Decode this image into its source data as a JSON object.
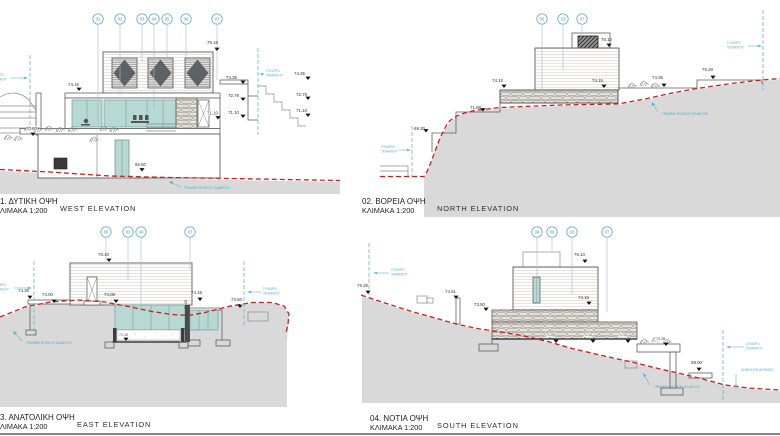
{
  "sheet": {
    "background": "#ffffff",
    "border_color": "#3a3a3a"
  },
  "colors": {
    "glass": "#b7d8d3",
    "terrain": "#d9d9d9",
    "ground_line_red": "#cc1f1f",
    "annotation_teal": "#57a8c7",
    "marker_blue": "#4a92b4"
  },
  "annotations": {
    "boundary_l1": "ΣΥΝΟΡΟ",
    "boundary_l2": "ΤΕΜΑΧΙΟΥ",
    "ground_line": "ΓΡΑΜΜΗ ΦΥΣΙΚΟΥ ΕΔΑΦΟΥΣ",
    "public_road": "ΔΗΜΟΣΙΟΣ ΔΡΟΜΟΣ"
  },
  "views": {
    "west": {
      "title": "1. ΔΥΤΙΚΗ ΟΨΗ",
      "scale_label": "ΛΙΜΑΚΑ 1:200",
      "title_en": "WEST ELEVATION",
      "markers": [
        "01",
        "02",
        "03",
        "04",
        "05",
        "06",
        "07"
      ],
      "levels": [
        "78.19",
        "74.15",
        "74.35",
        "72.79",
        "71.10",
        "74.35",
        "72.79",
        "71.10",
        "71.10",
        "70.80",
        "66.50"
      ]
    },
    "north": {
      "title": "02. ΒΟΡΕΙΑ ΟΨΗ",
      "scale_label": "ΚΛΙΜΑΚΑ 1:200",
      "title_en": "NORTH ELEVATION",
      "markers": [
        "06",
        "03",
        "07"
      ],
      "levels": [
        "76.10",
        "74.15",
        "74.15",
        "74.35",
        "75.28",
        "71.68",
        "69.30"
      ]
    },
    "east": {
      "title": "3. ΑΝΑΤΟΛΙΚΗ ΟΨΗ",
      "scale_label": "ΛΙΜΑΚΑ 1:200",
      "title_en": "EAST ELEVATION",
      "markers": [
        "06",
        "03",
        "04",
        "07"
      ],
      "levels": [
        "76.10",
        "74.35",
        "74.00",
        "74.08",
        "74.15",
        "73.25",
        "73.50",
        "71.10"
      ]
    },
    "south": {
      "title": "04. ΝΟΤΙΑ ΟΨΗ",
      "scale_label": "ΚΛΙΜΑΚΑ 1:200",
      "title_en": "SOUTH ELEVATION",
      "markers": [
        "04",
        "06",
        "03",
        "07"
      ],
      "levels": [
        "76.10",
        "75.28",
        "74.51",
        "73.50",
        "74.15",
        "71.05",
        "71.10",
        "71.10",
        "70.28",
        "68.00"
      ]
    }
  }
}
